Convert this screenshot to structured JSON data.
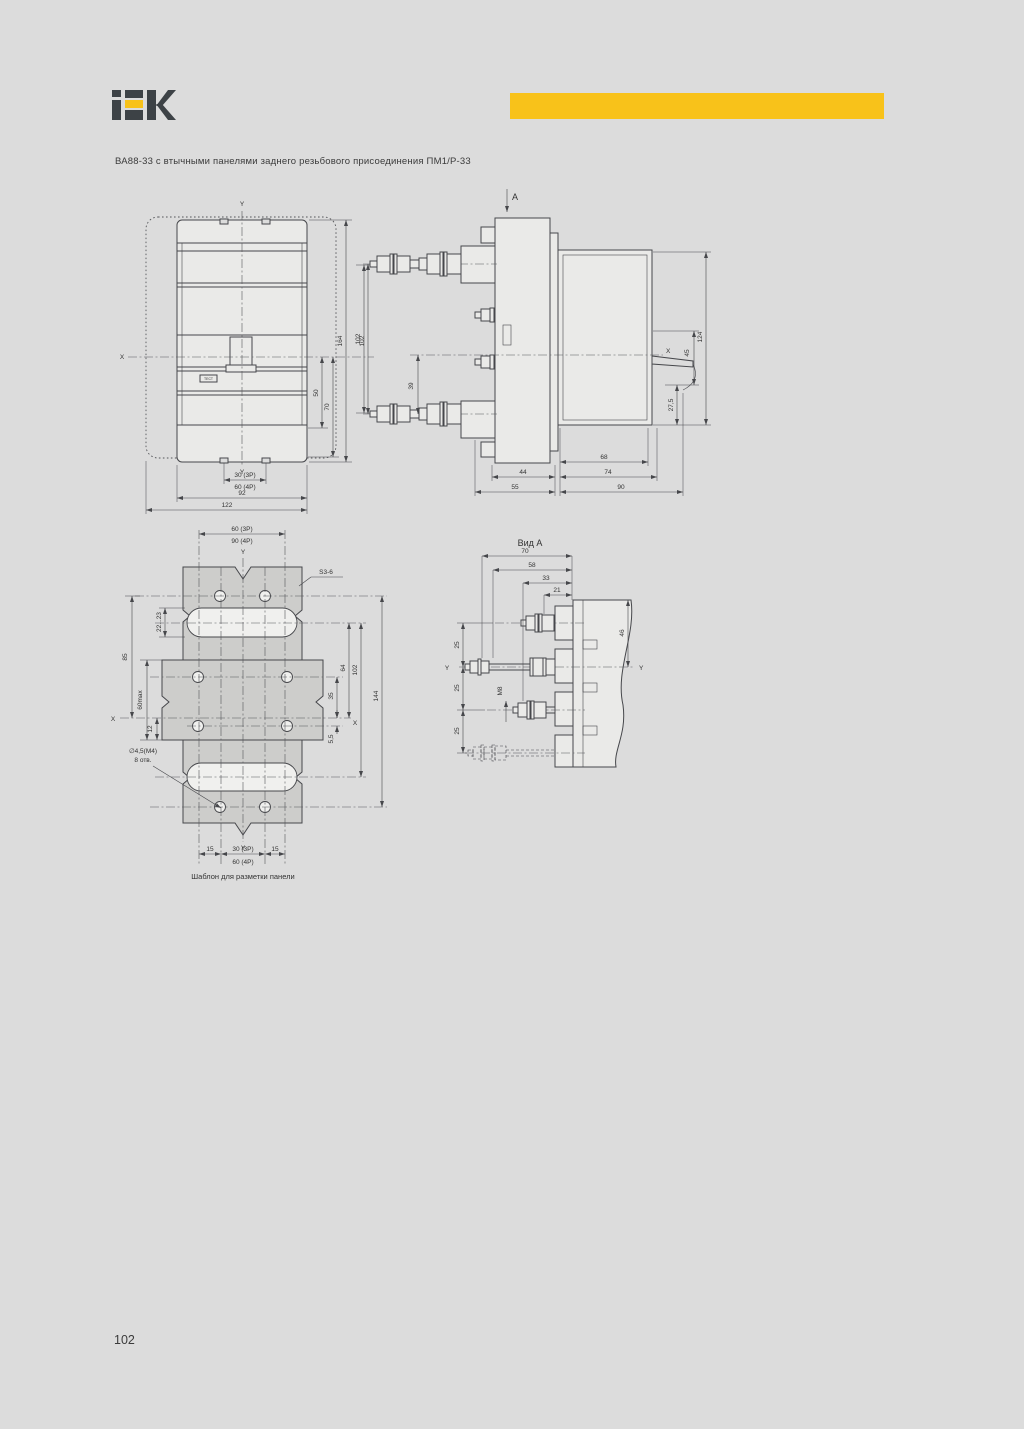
{
  "page": {
    "title": "ВА88-33 с втычными панелями заднего резьбового присоединения ПМ1/Р-33",
    "page_number": "102",
    "background_color": "#dcdcdc",
    "accent_color": "#f8c21a"
  },
  "brand": {
    "name": "IEK"
  },
  "front_view": {
    "axis_y_top": "Y",
    "axis_y_bottom": "Y",
    "axis_x": "X",
    "test_button": "ТЕСТ",
    "dim_50": "50",
    "dim_70": "70",
    "dim_164": "164",
    "dim_102": "102",
    "dim_30_3p": "30 (3P)",
    "dim_60_4p": "60 (4P)",
    "dim_92": "92",
    "dim_122": "122"
  },
  "side_view": {
    "view_arrow": "A",
    "axis_x": "X",
    "dim_102": "102",
    "dim_39": "39",
    "dim_124": "124",
    "dim_45": "45",
    "dim_27_5": "27,5",
    "dim_68": "68",
    "dim_74": "74",
    "dim_90": "90",
    "dim_44": "44",
    "dim_55": "55"
  },
  "template": {
    "caption": "Шаблон для разметки панели",
    "thickness": "S3-6",
    "holes_note_1": "∅4,5(М4)",
    "holes_note_2": "8 отв.",
    "axis_y_top": "Y",
    "axis_y_bottom": "Y",
    "axis_x_left": "X",
    "axis_x_right": "X",
    "dim_60_3p": "60 (3P)",
    "dim_90_4p": "90 (4P)",
    "dim_22_23": "22...23",
    "dim_85": "85",
    "dim_60max": "60max",
    "dim_12": "12",
    "dim_64": "64",
    "dim_102": "102",
    "dim_35": "35",
    "dim_5_5": "5,5",
    "dim_144": "144",
    "dim_15_l": "15",
    "dim_30_3p": "30 (3P)",
    "dim_15_r": "15",
    "dim_60_4p": "60 (4P)"
  },
  "view_a": {
    "title": "Вид А",
    "dim_70": "70",
    "dim_58": "58",
    "dim_33": "33",
    "dim_21": "21",
    "dim_46": "46",
    "dim_25_1": "25",
    "dim_25_2": "25",
    "dim_25_3": "25",
    "thread": "М8",
    "axis_y_left": "Y",
    "axis_y_right": "Y"
  }
}
